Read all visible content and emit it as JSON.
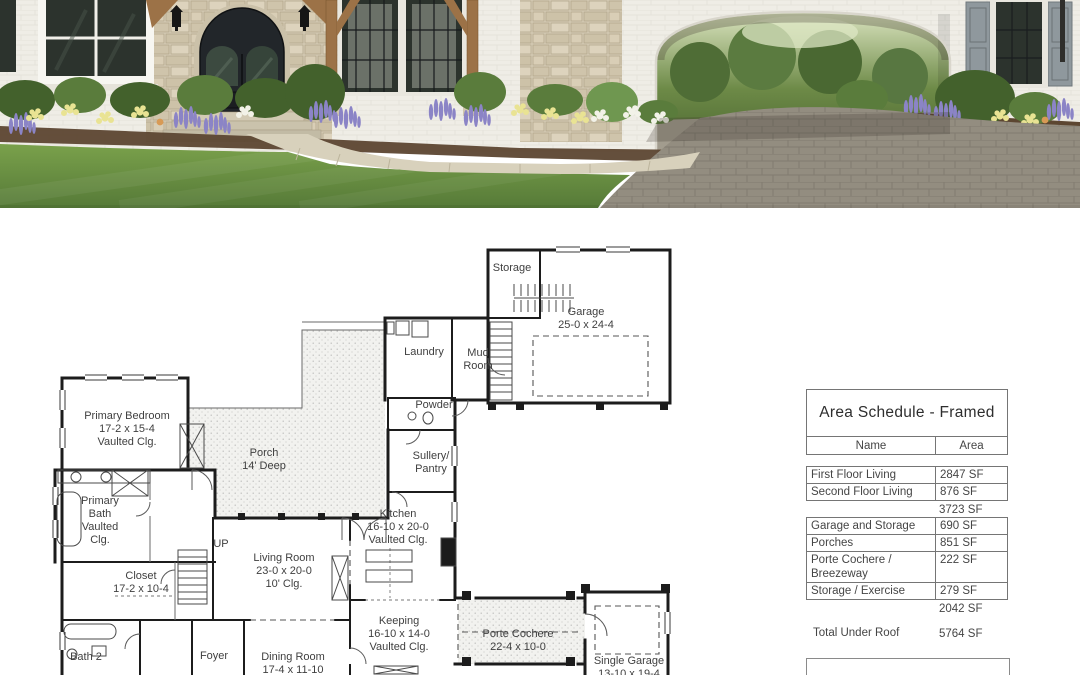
{
  "palette": {
    "wall": "#efede6",
    "stone": "#d6ccb6",
    "door": "#22262a",
    "glass": "#2c332d",
    "timber": "#9c7247",
    "shutter": "#8f989d",
    "foliage_dark": "#43612c",
    "foliage_mid": "#5a7c3c",
    "foliage_light": "#6f9750",
    "flower_purple": "#8b84c6",
    "flower_yellow": "#e9e393",
    "flower_white": "#f2f2e8",
    "mulch": "#5c4631",
    "walkway": "#d8d1bc",
    "driveway": "#938d80",
    "lawn_light": "#7aa14b",
    "lawn_dark": "#567a38",
    "ink": "#1c1c1c",
    "plantext": "#3f3f3f",
    "tblborder": "#757575",
    "tbltext": "#454545"
  },
  "area_schedule": {
    "title": "Area Schedule - Framed",
    "columns": [
      "Name",
      "Area"
    ],
    "rows": [
      {
        "name": "First Floor Living",
        "area": "2847 SF",
        "style": "bordered"
      },
      {
        "name": "Second Floor Living",
        "area": "876 SF",
        "style": "bordered"
      },
      {
        "name": "",
        "area": "3723 SF",
        "style": "subtotal"
      },
      {
        "name": "Garage and Storage",
        "area": "690 SF",
        "style": "bordered"
      },
      {
        "name": "Porches",
        "area": "851 SF",
        "style": "bordered"
      },
      {
        "name": "Porte Cochere /\nBreezeway",
        "area": "222 SF",
        "style": "bordered"
      },
      {
        "name": "Storage / Exercise",
        "area": "279 SF",
        "style": "bordered"
      },
      {
        "name": "",
        "area": "2042 SF",
        "style": "subtotal"
      },
      {
        "name": "Total Under Roof",
        "area": "5764 SF",
        "style": "total"
      }
    ]
  },
  "floor_plan": {
    "rooms": [
      {
        "id": "storage",
        "lines": [
          "Storage"
        ]
      },
      {
        "id": "garage",
        "lines": [
          "Garage",
          "25-0 x 24-4"
        ]
      },
      {
        "id": "laundry",
        "lines": [
          "Laundry"
        ]
      },
      {
        "id": "mud-room",
        "lines": [
          "Mud",
          "Room"
        ]
      },
      {
        "id": "powder",
        "lines": [
          "Powder"
        ]
      },
      {
        "id": "sullery-pantry",
        "lines": [
          "Sullery/",
          "Pantry"
        ]
      },
      {
        "id": "porch",
        "lines": [
          "Porch",
          "14' Deep"
        ]
      },
      {
        "id": "primary-bedroom",
        "lines": [
          "Primary Bedroom",
          "17-2 x 15-4",
          "Vaulted Clg."
        ]
      },
      {
        "id": "primary-bath",
        "lines": [
          "Primary",
          "Bath",
          "Vaulted",
          "Clg."
        ]
      },
      {
        "id": "stairs-up",
        "lines": [
          "UP"
        ]
      },
      {
        "id": "kitchen",
        "lines": [
          "Kitchen",
          "16-10 x 20-0",
          "Vaulted Clg."
        ]
      },
      {
        "id": "closet",
        "lines": [
          "Closet",
          "17-2 x 10-4"
        ]
      },
      {
        "id": "living-room",
        "lines": [
          "Living Room",
          "23-0 x 20-0",
          "10' Clg."
        ]
      },
      {
        "id": "keeping",
        "lines": [
          "Keeping",
          "16-10 x 14-0",
          "Vaulted Clg."
        ]
      },
      {
        "id": "bath-2",
        "lines": [
          "Bath 2"
        ]
      },
      {
        "id": "foyer",
        "lines": [
          "Foyer"
        ]
      },
      {
        "id": "dining-room",
        "lines": [
          "Dining Room",
          "17-4 x 11-10",
          "10' Clg."
        ]
      },
      {
        "id": "porte-cochere",
        "lines": [
          "Porte Cochere",
          "22-4 x 10-0"
        ]
      },
      {
        "id": "single-garage",
        "lines": [
          "Single Garage",
          "13-10 x 19-4"
        ]
      }
    ]
  }
}
